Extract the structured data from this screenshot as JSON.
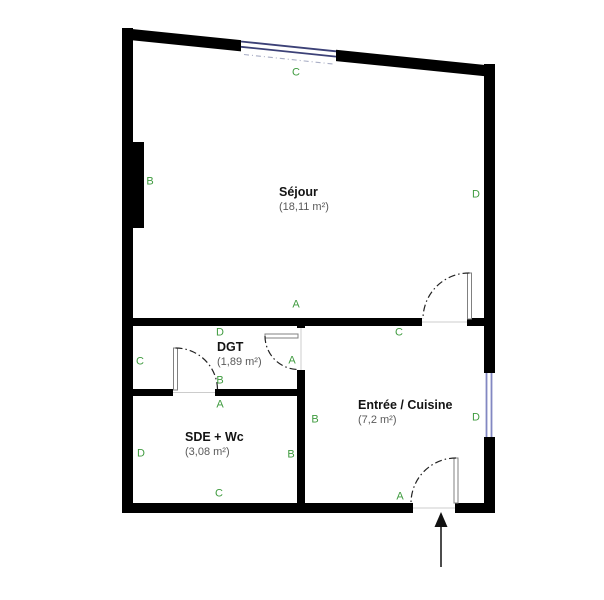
{
  "rooms": {
    "sejour": {
      "name": "Séjour",
      "area": "(18,11 m²)",
      "walls": {
        "top": "C",
        "left": "B",
        "right": "D",
        "bottom": "A"
      }
    },
    "dgt": {
      "name": "DGT",
      "area": "(1,89 m²)",
      "walls": {
        "top": "D",
        "left": "C",
        "right": "A",
        "bottom": "B"
      }
    },
    "sde": {
      "name": "SDE + Wc",
      "area": "(3,08 m²)",
      "walls": {
        "top": "A",
        "left": "D",
        "right": "B",
        "bottom": "C"
      }
    },
    "entree": {
      "name": "Entrée / Cuisine",
      "area": "(7,2 m²)",
      "walls": {
        "top": "C",
        "left": "B",
        "right": "D",
        "bottom": "A"
      }
    }
  },
  "colors": {
    "wall": "#000000",
    "label": "#3f9b3f",
    "window_top": "#3c4177",
    "window_side": "#8287c2",
    "door_leaf": "#808080",
    "arc": "#222222"
  }
}
